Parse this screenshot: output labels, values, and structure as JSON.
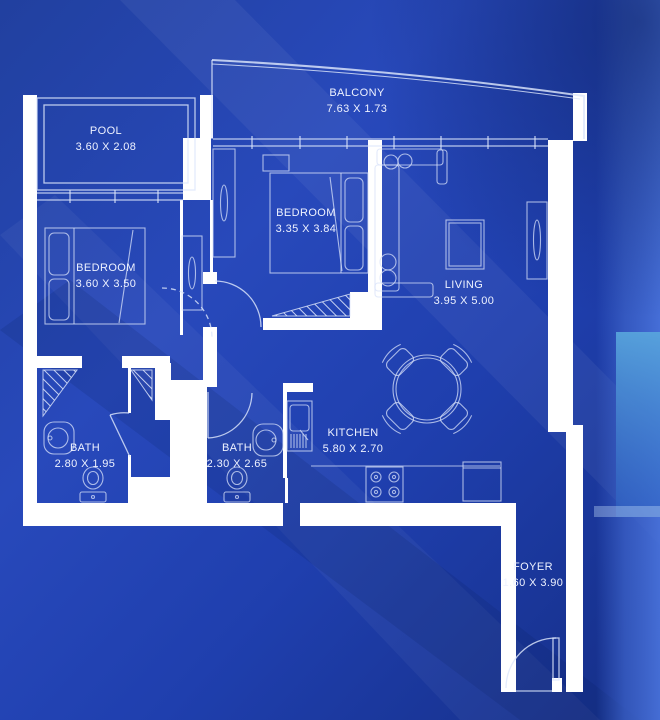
{
  "plan": {
    "type": "apartment-blueprint-floor-plan",
    "rooms": [
      {
        "id": "pool",
        "name": "POOL",
        "dims": "3.60 X 2.08"
      },
      {
        "id": "balcony",
        "name": "BALCONY",
        "dims": "7.63 X 1.73"
      },
      {
        "id": "bedroom-center",
        "name": "BEDROOM",
        "dims": "3.35 X 3.84"
      },
      {
        "id": "bedroom-left",
        "name": "BEDROOM",
        "dims": "3.60 X 3.50"
      },
      {
        "id": "living",
        "name": "LIVING",
        "dims": "3.95 X 5.00"
      },
      {
        "id": "bath-left",
        "name": "BATH",
        "dims": "2.80 X 1.95"
      },
      {
        "id": "bath-center",
        "name": "BATH",
        "dims": "2.30 X 2.65"
      },
      {
        "id": "kitchen",
        "name": "KITCHEN",
        "dims": "5.80 X 2.70"
      },
      {
        "id": "foyer",
        "name": "FOYER",
        "dims": "1.60 X 3.90"
      }
    ],
    "palette": {
      "background_blue": "#2245b4",
      "background_dark": "#132c7e",
      "background_light": "#2f55c8",
      "right_band_blue": "#3c62c9",
      "window_glow_cyan": "#59a7dd",
      "wall_white": "#ffffff",
      "line_white": "#dde6fb",
      "text_white": "#eef2ff"
    }
  }
}
